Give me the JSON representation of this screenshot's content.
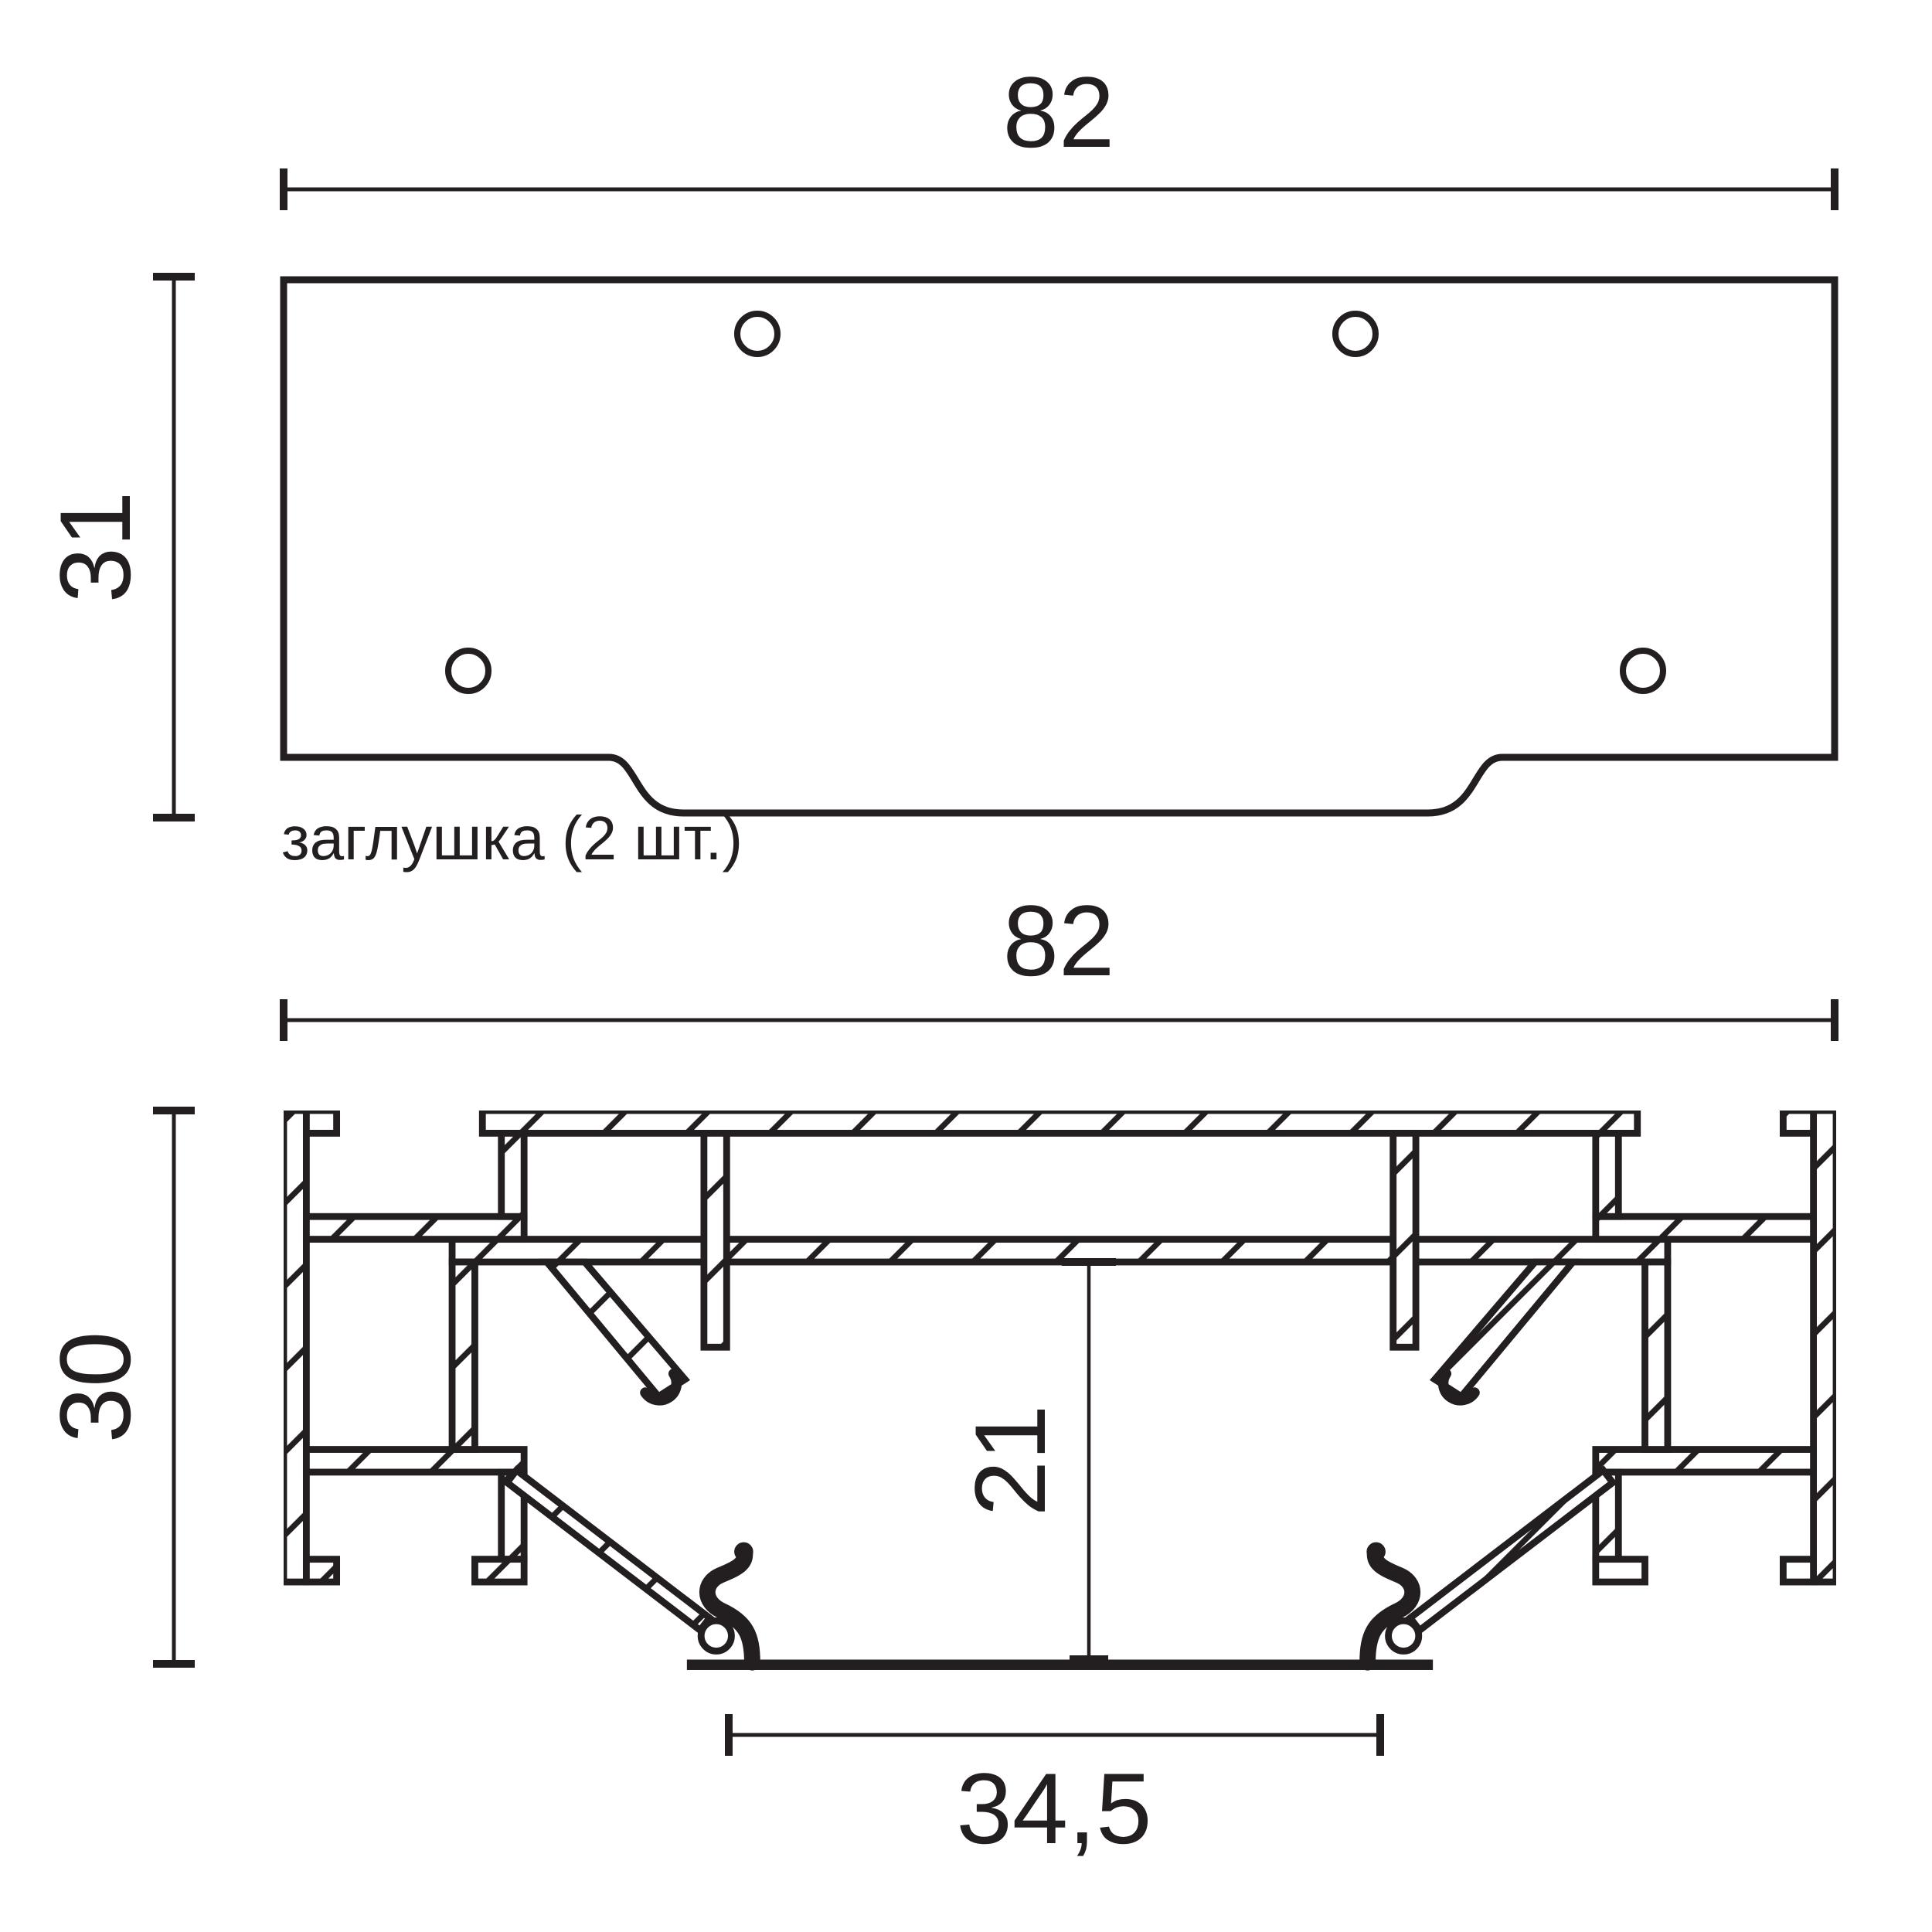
{
  "page": {
    "background": "#ffffff",
    "ink_color": "#231f20",
    "type_label": "technical-drawing"
  },
  "end_cap_view": {
    "caption": "заглушка (2 шт.)",
    "width_dim": "82",
    "height_dim": "31",
    "holes_count": "4"
  },
  "profile_view": {
    "width_dim": "82",
    "height_dim": "30",
    "inner_height_dim": "21",
    "opening_width_dim": "34,5"
  }
}
